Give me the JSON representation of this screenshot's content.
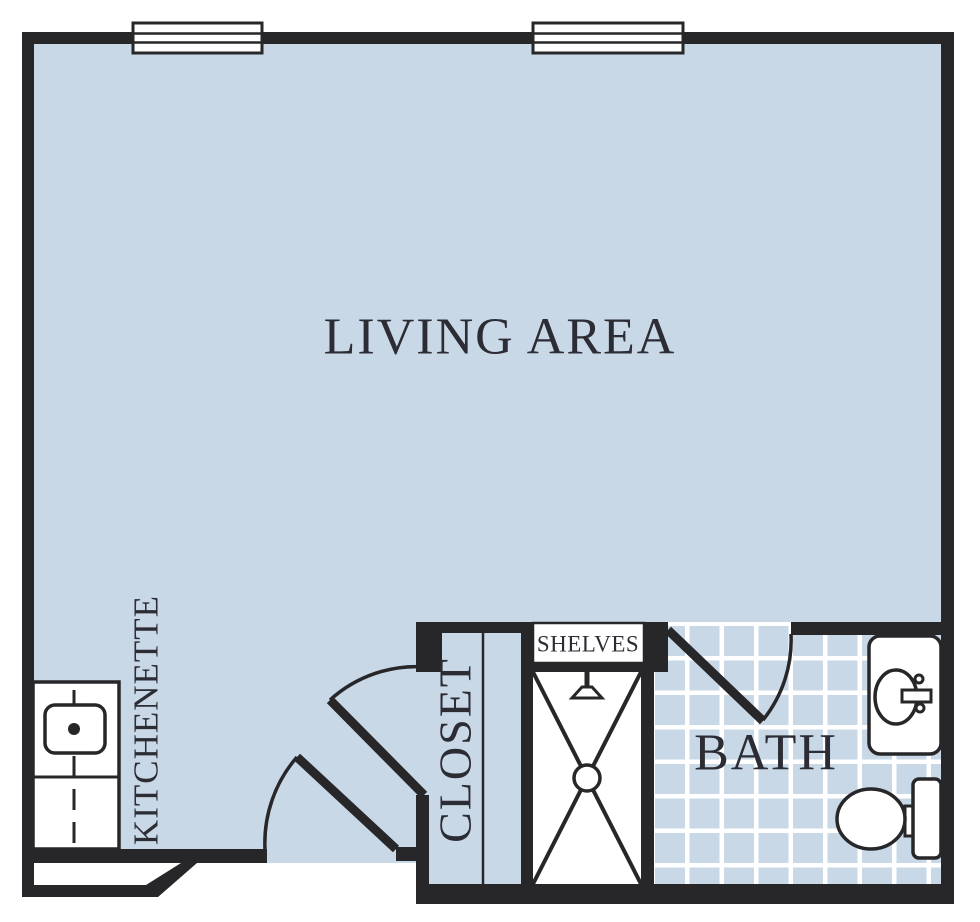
{
  "plan": {
    "type": "floor-plan",
    "labels": {
      "living_area": "LIVING AREA",
      "kitchenette": "KITCHENETTE",
      "closet": "CLOSET",
      "shelves": "SHELVES",
      "bath": "BATH"
    },
    "fixtures": [
      "window",
      "window",
      "entry-door",
      "closet-door",
      "bath-door",
      "kitchenette-counter",
      "kitchenette-sink",
      "shower",
      "shower-head",
      "shower-drain",
      "shelf-unit",
      "bathroom-vanity-sink",
      "toilet",
      "tile-floor"
    ]
  },
  "colors": {
    "floor": "#c9d8e7",
    "wall": "#272729",
    "tile_line": "#ffffff",
    "fixture_fill": "#ffffff",
    "label": "#2c2c34",
    "background": "#ffffff"
  }
}
